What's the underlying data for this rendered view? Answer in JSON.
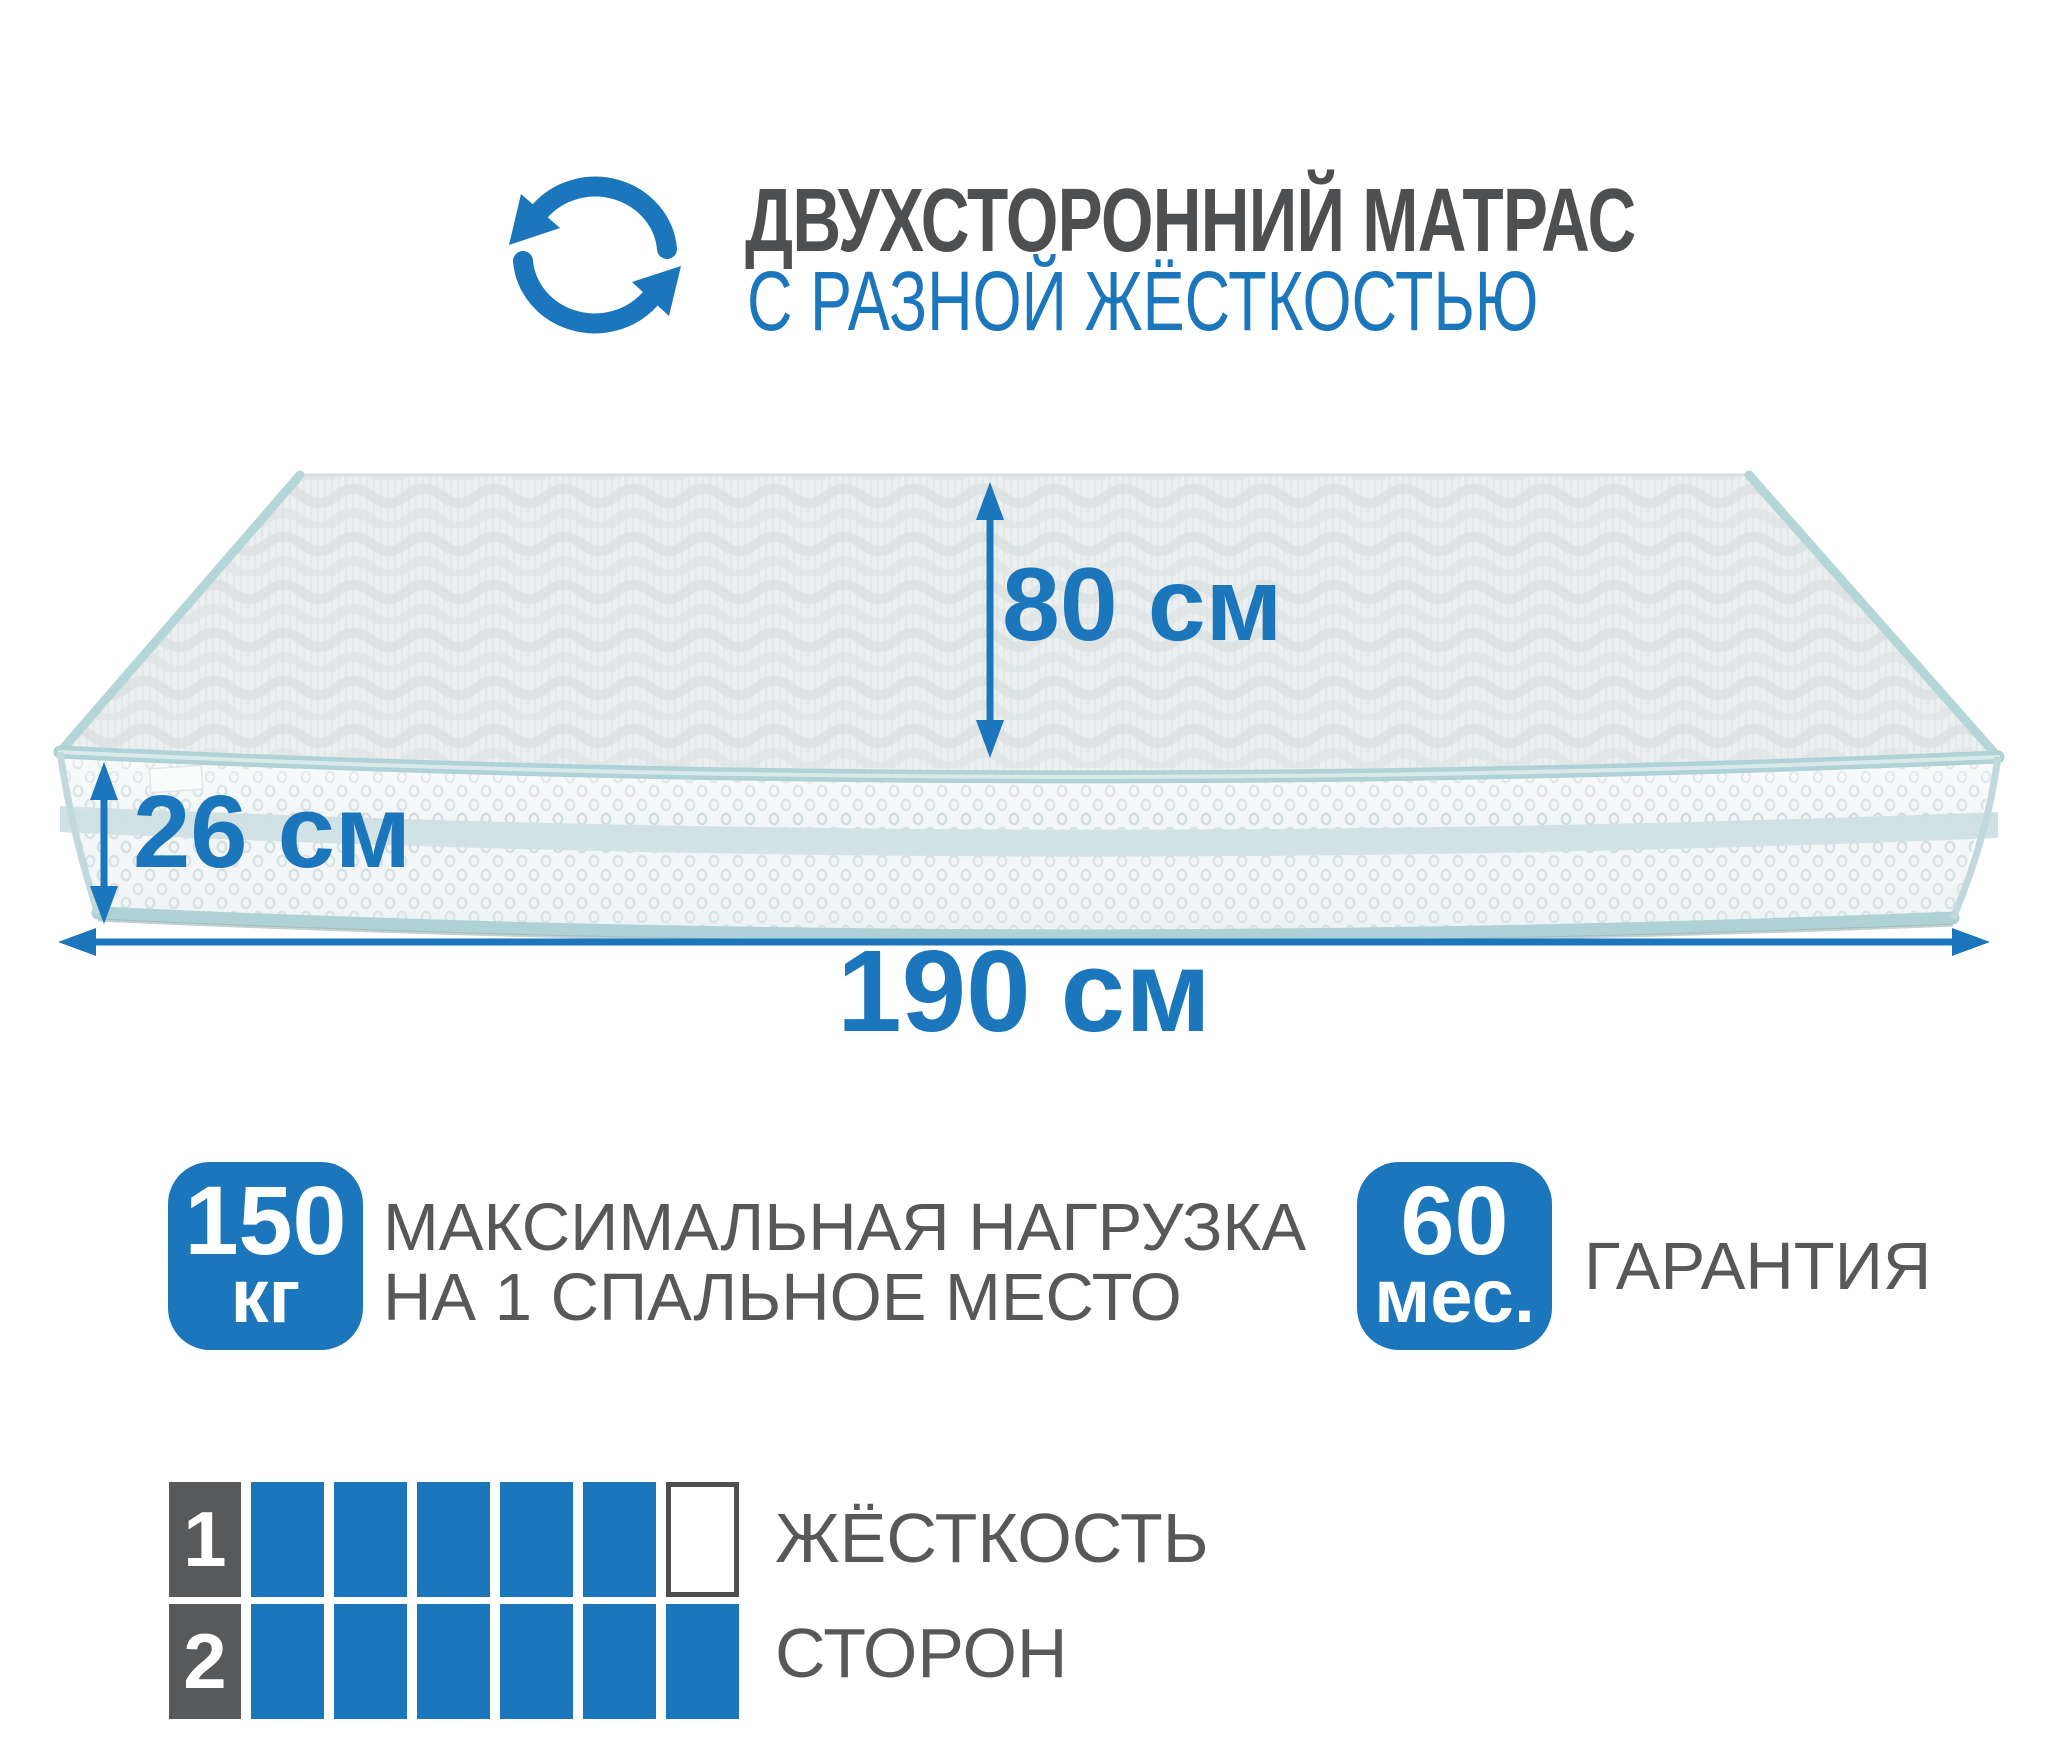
{
  "header": {
    "title_line1": "ДВУХСТОРОННИЙ МАТРАС",
    "title_line2": "С РАЗНОЙ ЖЁСТКОСТЬЮ",
    "icon": "rotate-arrows-icon"
  },
  "dimensions": {
    "width": {
      "value": "80",
      "unit": "см"
    },
    "height": {
      "value": "26",
      "unit": "см"
    },
    "length": {
      "value": "190",
      "unit": "см"
    }
  },
  "badges": {
    "max_load": {
      "value": "150",
      "unit": "кг",
      "label_line1": "МАКСИМАЛЬНАЯ НАГРУЗКА",
      "label_line2": "НА 1 СПАЛЬНОЕ МЕСТО"
    },
    "warranty": {
      "value": "60",
      "unit": "мес.",
      "label": "ГАРАНТИЯ"
    }
  },
  "firmness": {
    "caption_line1": "ЖЁСТКОСТЬ",
    "caption_line2": "СТОРОН",
    "scale_max": 6,
    "rows": [
      {
        "label": "1",
        "filled": 5
      },
      {
        "label": "2",
        "filled": 6
      }
    ]
  },
  "colors": {
    "accent_blue": "#1b76bc",
    "dark_gray_text": "#4e4f51",
    "medium_gray_text": "#57585a",
    "firmness_label_gray": "#58595b",
    "teal_piping": "#aed2d6",
    "front_band": "#cddfe2",
    "mattress_front": "#f3f6f7",
    "mattress_top": "#ebefef"
  }
}
